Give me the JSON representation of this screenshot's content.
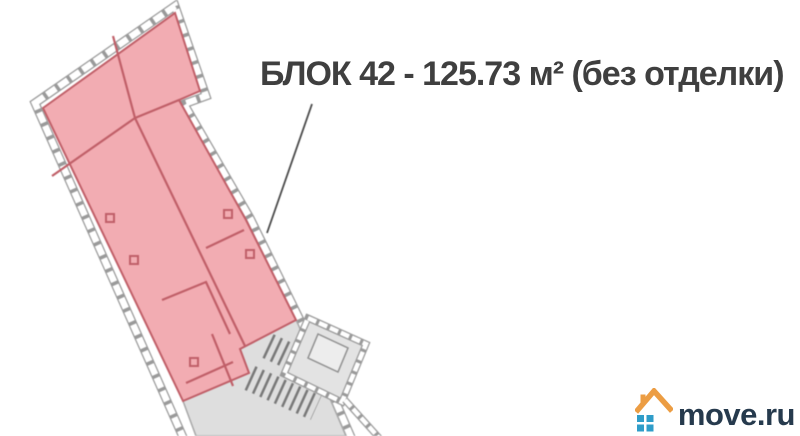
{
  "annotation": {
    "block_label": "БЛОК 42 - 125.73 м² (без отделки)",
    "block_name": "БЛОК 42",
    "area_m2": "125.73",
    "finish": "без отделки"
  },
  "floorplan": {
    "kind": "building floor plan, rotated footprint",
    "highlighted_block_fill": "#f2acb2",
    "interior_wall_color": "#c05f68",
    "building_outline_color": "#9a9a9a",
    "unselected_area_fill": "#dedede",
    "features": [
      "window band along perimeter",
      "stair core at bottom right",
      "column markers",
      "gray non-selected section at bottom"
    ]
  },
  "watermark": {
    "text": "move.ru",
    "text_color": "#263a4d",
    "house_roof_color": "#ec9d43",
    "house_window_color": "#2f9dc9"
  }
}
